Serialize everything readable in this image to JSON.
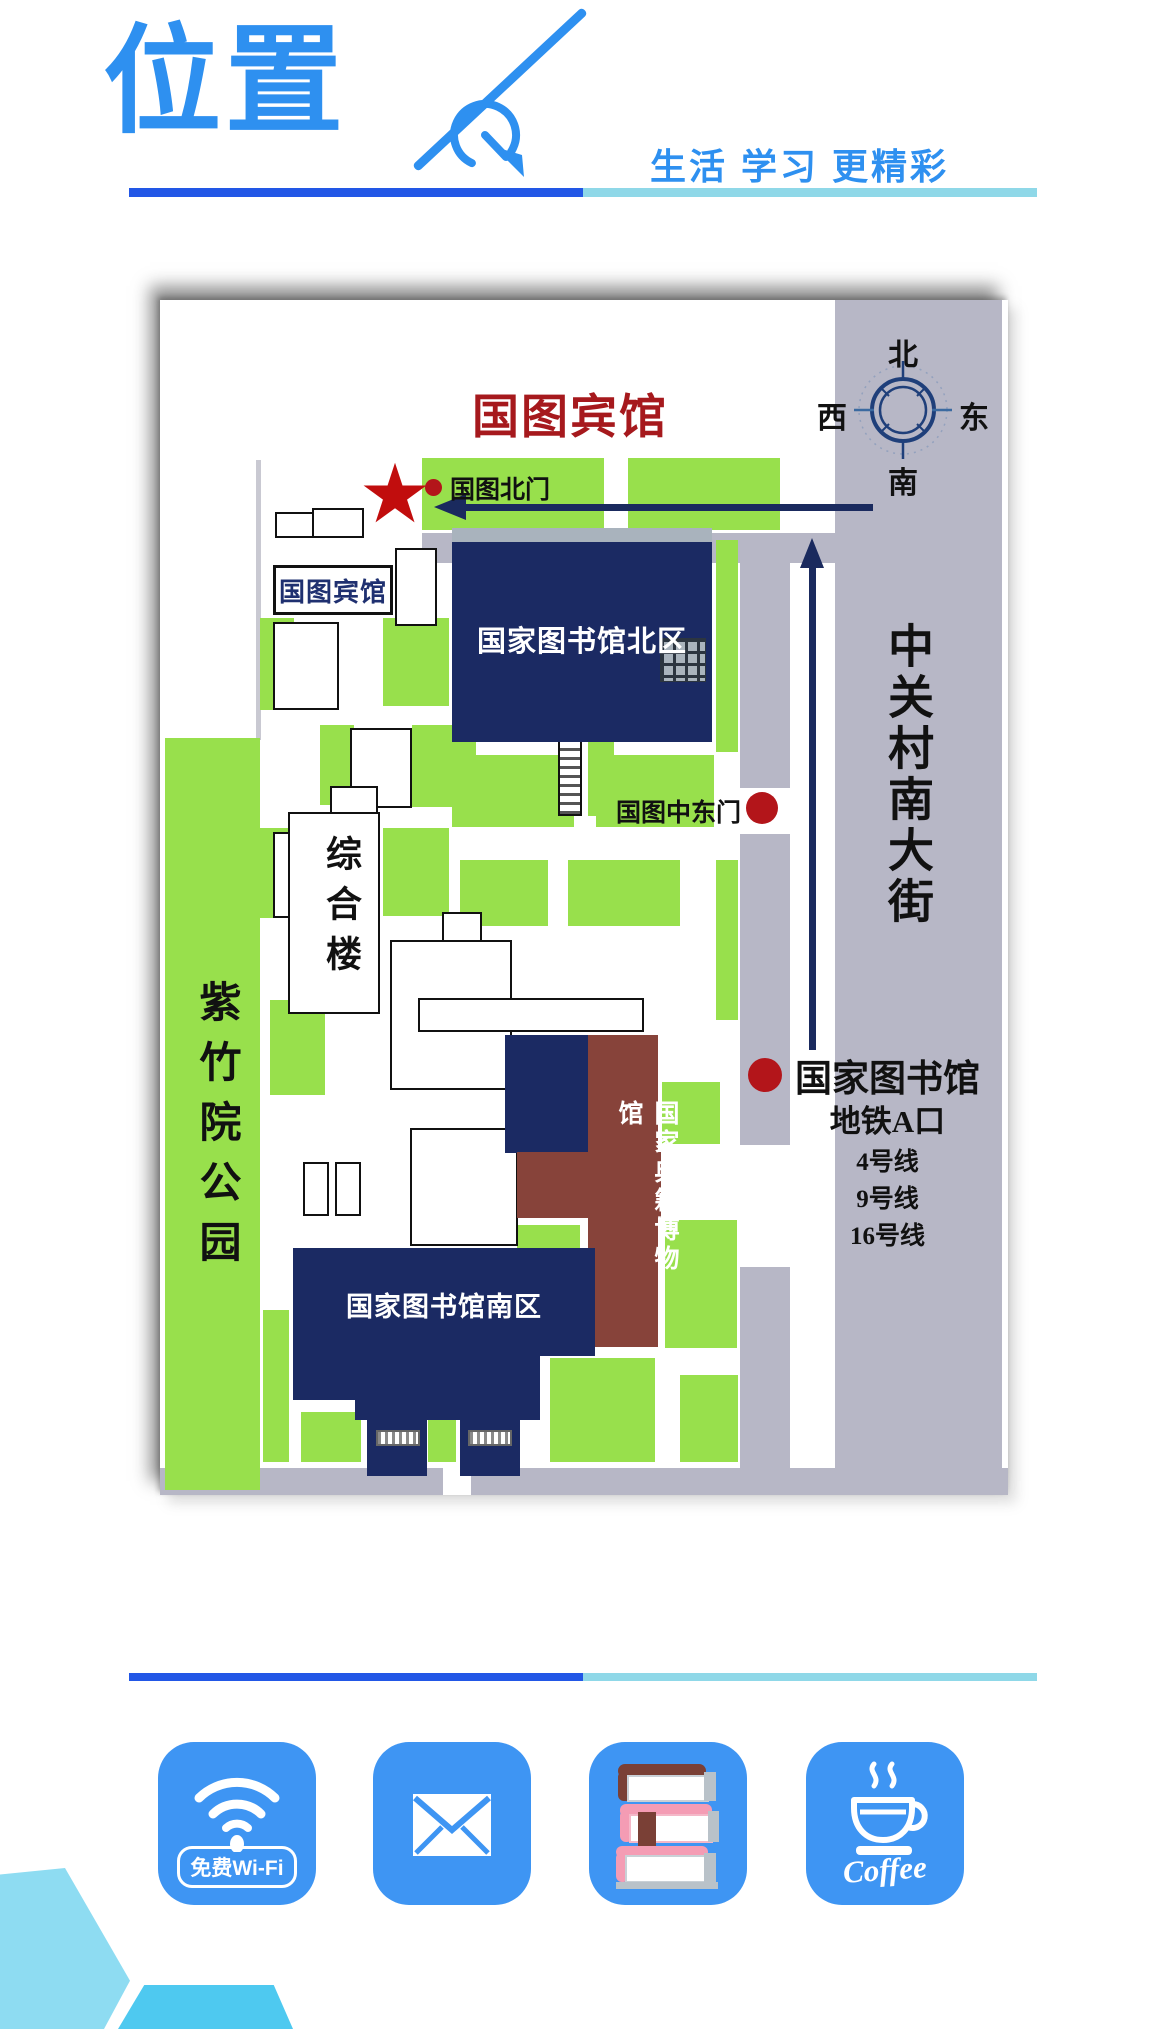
{
  "header": {
    "title": "位置",
    "tagline": "生活 学习 更精彩"
  },
  "map": {
    "title": "国图宾馆",
    "star_glyph": "★",
    "north_gate_label": "国图北门",
    "hotel_box_label": "国图宾馆",
    "north_library_label": "国家图书馆北区",
    "mid_east_gate_label": "国图中东门",
    "complex_building_label": "综合楼",
    "park_label": "紫竹院公园",
    "museum_label": "国家典籍博物馆",
    "south_library_label": "国家图书馆南区",
    "street_label": "中关村南大街",
    "compass": {
      "north": "北",
      "south": "南",
      "east": "东",
      "west": "西"
    },
    "subway": {
      "name": "国家图书馆",
      "entrance": "地铁A口",
      "lines": [
        "4号线",
        "9号线",
        "16号线"
      ]
    }
  },
  "features": {
    "wifi_label": "免费Wi-Fi",
    "coffee_label": "Coffee"
  },
  "colors": {
    "accent_blue": "#2e90f0",
    "rule_dark": "#2257e6",
    "rule_light": "#8fd8e8",
    "map_red": "#a6191d",
    "dot_red": "#b3151a",
    "lawn_green": "#98e04c",
    "street_gray": "#b7b7c6",
    "building_navy": "#1b2a63",
    "museum_brown": "#87433a",
    "tile_blue": "#3e95f3"
  }
}
